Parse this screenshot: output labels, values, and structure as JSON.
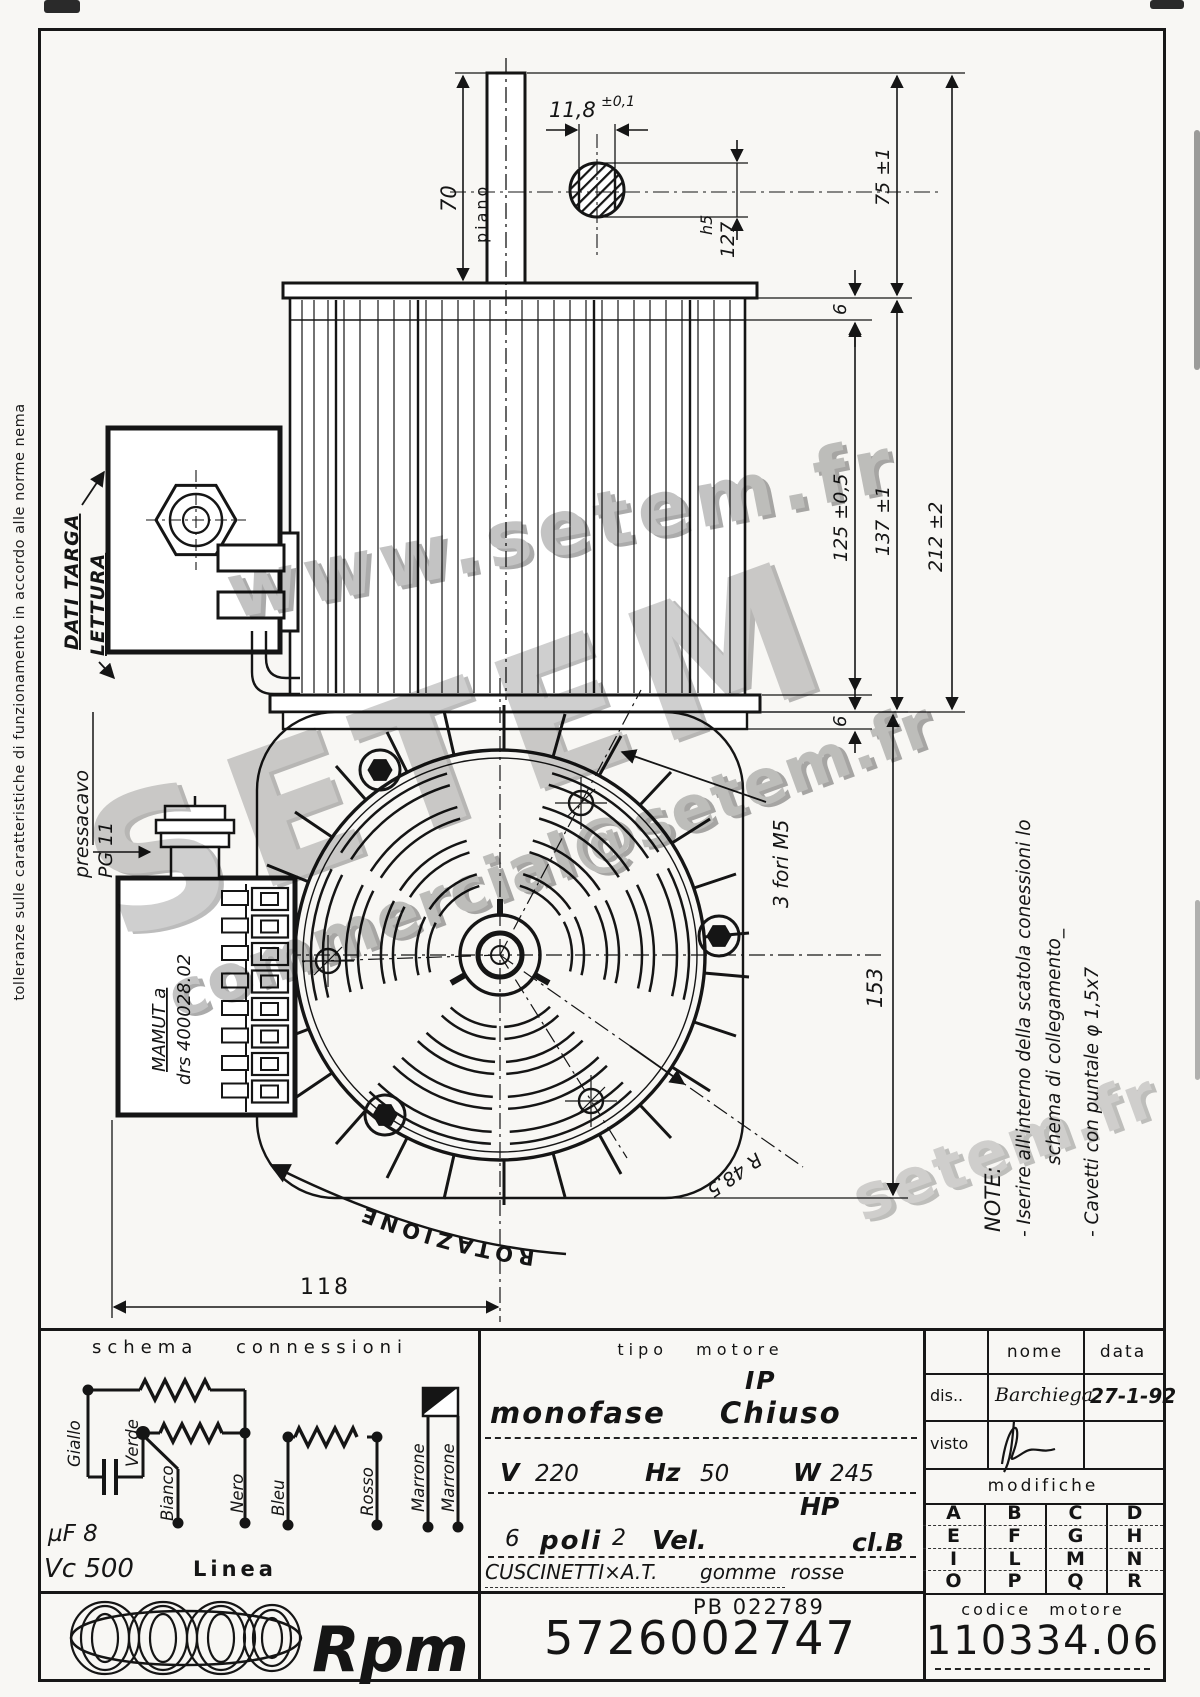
{
  "colors": {
    "paper": "#f8f7f4",
    "ink": "#151515",
    "watermark": "#c3c3c3"
  },
  "margin_note": "tolleranze sulle caratteristiche di funzionamento in accordo alle norme nema",
  "watermarks": {
    "line1": "www.setem.fr",
    "line2": "SETEM",
    "line3": "commercial@setem.fr",
    "line4": "setem.fr"
  },
  "side_view": {
    "dim_70": "70",
    "piano": "piano",
    "flat_width": "11,8",
    "flat_tol": "±0,1",
    "shaft_h5": "h5",
    "shaft_dia": "127",
    "dim_75": "75 ±1",
    "dim_6_top": "6",
    "dim_125": "125 ±0,5",
    "dim_137": "137 ±1",
    "dim_212": "212 ±2",
    "dim_6_bottom": "6",
    "dati_targa": "DATI TARGA",
    "lettura": "LETTURA"
  },
  "fan_view": {
    "pressacavo": "pressacavo",
    "pg": "PG 11",
    "mamut_1": "MAMUT a",
    "mamut_2": "drs 400028.02",
    "fori": "3 fori M5",
    "radius": "R 48.5",
    "rotazione": "ROTAZIONE",
    "dim_153": "153",
    "dim_118": "118"
  },
  "note": {
    "title": "NOTE:",
    "line1": "- Iserire all'interno della scatola conessioni lo",
    "line2": "schema di collegamento_",
    "line3": "- Cavetti con puntale φ 1,5x7"
  },
  "schema": {
    "title": "schema connessioni",
    "wire_giallo": "Giallo",
    "wire_verde": "Verde",
    "wire_bianco": "Bianco",
    "wire_nero": "Nero",
    "wire_bleu": "Bleu",
    "wire_rosso": "Rosso",
    "wire_marrone1": "Marrone",
    "wire_marrone2": "Marrone",
    "cap": "µF 8",
    "vc": "Vc 500",
    "linea": "Linea"
  },
  "tipo": {
    "title": "tipo motore",
    "ip": "IP",
    "motor_type": "monofase Chiuso",
    "v_label": "V",
    "v": "220",
    "hz_label": "Hz",
    "hz": "50",
    "w_label": "W",
    "w": "245",
    "hp": "HP",
    "poles": "6",
    "poles_label": "poli",
    "speeds": "2",
    "speeds_label": "Vel.",
    "insulation": "cl.B",
    "bearings": "CUSCINETTI×A.T.",
    "bearings2": "gomme rosse",
    "pb": "PB 022789",
    "part_number": "5726002747"
  },
  "approval": {
    "nome": "nome",
    "data": "data",
    "dis": "dis..",
    "dis_name": "Barchiega",
    "dis_date": "27-1-92",
    "visto": "visto",
    "modifiche": "modifiche",
    "letters": [
      [
        "A",
        "B",
        "C",
        "D"
      ],
      [
        "E",
        "F",
        "G",
        "H"
      ],
      [
        "I",
        "L",
        "M",
        "N"
      ],
      [
        "O",
        "P",
        "Q",
        "R"
      ]
    ],
    "codice_label": "codice motore",
    "codice": "110334.06"
  },
  "logo": {
    "brand": "Rpm"
  }
}
